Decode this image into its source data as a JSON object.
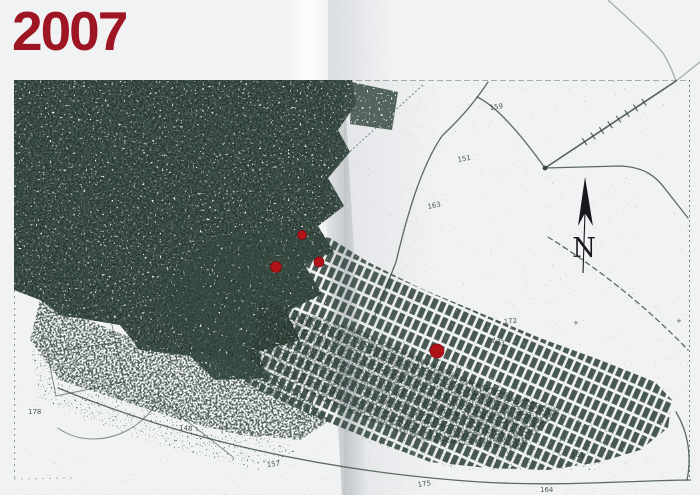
{
  "css_vars": {
    "--page-bg": "#eaecee",
    "--paper": "#f1f2f4",
    "--ink": "#36483f",
    "--ink-dark": "#243229",
    "--marker-red": "#b11217",
    "--year-red": "#9e1524",
    "--compass-black": "#17191c"
  },
  "header": {
    "year_label": "2007"
  },
  "map": {
    "description": "scanned street map, urban extent in 2007",
    "compass": {
      "label": "N"
    },
    "markers": [
      {
        "x": 302,
        "y": 235,
        "r": 4.5
      },
      {
        "x": 276,
        "y": 267,
        "r": 5.5
      },
      {
        "x": 319,
        "y": 262,
        "r": 5
      },
      {
        "x": 437,
        "y": 351,
        "r": 7
      }
    ],
    "road_labels": [
      {
        "text": "159",
        "x": 490,
        "y": 110,
        "rot": -8
      },
      {
        "text": "151",
        "x": 458,
        "y": 162,
        "rot": -10
      },
      {
        "text": "163",
        "x": 428,
        "y": 209,
        "rot": -12
      },
      {
        "text": "172",
        "x": 504,
        "y": 324,
        "rot": -6
      },
      {
        "text": "173",
        "x": 491,
        "y": 342,
        "rot": 18
      },
      {
        "text": "175",
        "x": 418,
        "y": 487,
        "rot": -8
      },
      {
        "text": "164",
        "x": 540,
        "y": 492,
        "rot": 0
      },
      {
        "text": "161",
        "x": 571,
        "y": 457,
        "rot": 0
      },
      {
        "text": "157",
        "x": 267,
        "y": 467,
        "rot": -6
      },
      {
        "text": "148",
        "x": 179,
        "y": 430,
        "rot": 4
      },
      {
        "text": "178",
        "x": 28,
        "y": 414,
        "rot": 0
      },
      {
        "text": "84",
        "x": 297,
        "y": 420,
        "rot": 0
      },
      {
        "text": "+",
        "x": 573,
        "y": 325,
        "rot": 0
      },
      {
        "text": "+",
        "x": 676,
        "y": 323,
        "rot": 0
      }
    ]
  }
}
